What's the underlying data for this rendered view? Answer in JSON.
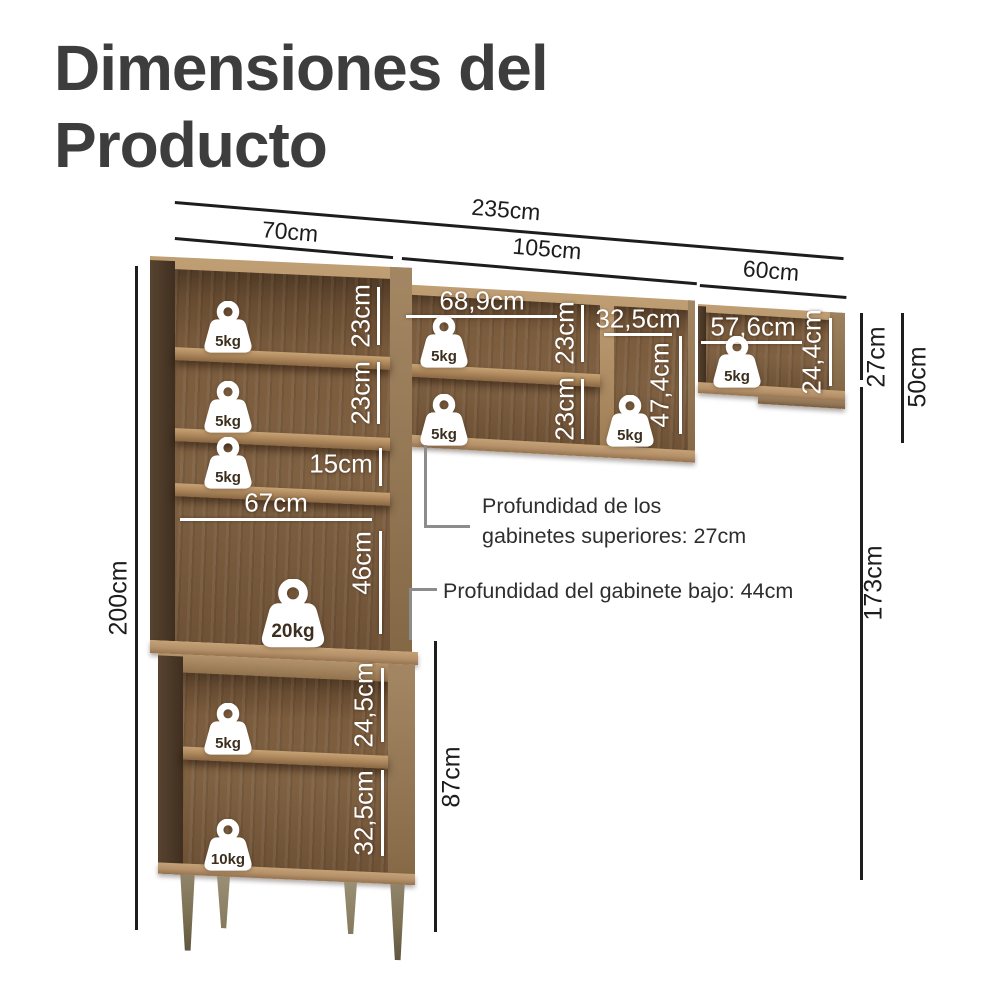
{
  "title": "Dimensiones del Producto",
  "dims": {
    "total_width": "235cm",
    "left_width": "70cm",
    "mid_width": "105cm",
    "right_width": "60cm",
    "total_height": "200cm",
    "upper_cab_height": "27cm",
    "upper_total": "50cm",
    "below_height": "173cm",
    "base_height": "87cm",
    "left_shelf1": "23cm",
    "left_shelf2": "23cm",
    "left_shelf3": "15cm",
    "left_inner_width": "67cm",
    "left_open_height": "46cm",
    "base_shelf1": "24,5cm",
    "base_shelf2": "32,5cm",
    "mid_inner_width": "68,9cm",
    "mid_shelf1": "23cm",
    "mid_shelf2": "23cm",
    "mid_right_width": "32,5cm",
    "mid_right_height": "47,4cm",
    "right_inner_width": "57,6cm",
    "right_inner_height": "24,4cm"
  },
  "weights": {
    "five": "5kg",
    "ten": "10kg",
    "twenty": "20kg"
  },
  "annotations": {
    "upper_depth": "Profundidad de los gabinetes superiores: 27cm",
    "lower_depth": "Profundidad del gabinete bajo: 44cm"
  },
  "colors": {
    "wood_frame": "#ab8a61",
    "wood_back": "#7b5c3d",
    "wood_side": "#4b3827",
    "title_text": "#3d3d3d",
    "dimension_line": "#1d1d1d",
    "overlay_white": "#ffffff",
    "bracket_gray": "#8c8c8c"
  }
}
